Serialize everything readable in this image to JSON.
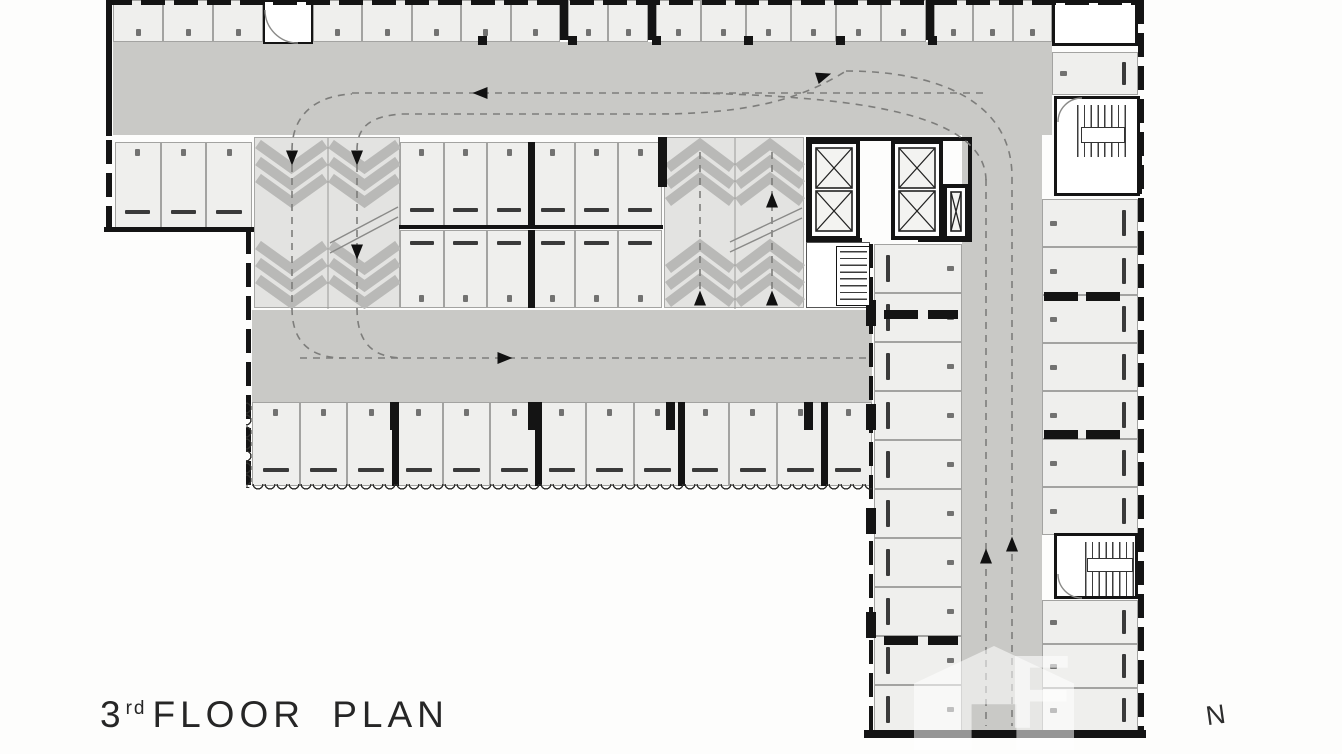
{
  "title": {
    "number": "3",
    "ordinal": "rd",
    "text": "FLOOR PLAN"
  },
  "north_label": "N",
  "watermark_label": "F",
  "colors": {
    "bg": "#fdfdfc",
    "lane": "#c9c9c6",
    "ramp": "#e3e3e1",
    "chevron": "#b9b9b7",
    "stall": "#efefed",
    "stall_border": "#a3a3a1",
    "wall": "#141414",
    "wheel_stop": "#3a3a3a",
    "path": "#7d7d7b",
    "solid_line": "#8a8a88",
    "arrow": "#111111",
    "text": "#262626"
  },
  "plan": {
    "lanes": [
      {
        "x": 113,
        "y": 42,
        "w": 939,
        "h": 93
      },
      {
        "x": 252,
        "y": 310,
        "w": 620,
        "h": 92
      },
      {
        "x": 962,
        "y": 135,
        "w": 80,
        "h": 597
      }
    ],
    "rooms": [
      {
        "x": 263,
        "y": 0,
        "w": 50,
        "h": 44,
        "b": "2px solid #141414"
      },
      {
        "x": 1052,
        "y": 0,
        "w": 86,
        "h": 46,
        "b": "3px solid #141414"
      },
      {
        "x": 806,
        "y": 242,
        "w": 64,
        "h": 66,
        "b": "1.5px solid #555555"
      }
    ],
    "stall_rows": [
      {
        "x": 113,
        "y": 0,
        "w": 150,
        "h": 42,
        "n": 3,
        "open": "down",
        "noStop": true
      },
      {
        "x": 313,
        "y": 0,
        "w": 247,
        "h": 42,
        "n": 5,
        "open": "down",
        "noStop": true
      },
      {
        "x": 568,
        "y": 0,
        "w": 80,
        "h": 42,
        "n": 2,
        "open": "down",
        "noStop": true
      },
      {
        "x": 656,
        "y": 0,
        "w": 270,
        "h": 42,
        "n": 6,
        "open": "down",
        "noStop": true
      },
      {
        "x": 934,
        "y": 0,
        "w": 118,
        "h": 42,
        "n": 3,
        "open": "down",
        "noStop": true
      },
      {
        "x": 115,
        "y": 142,
        "w": 137,
        "h": 86,
        "n": 3,
        "open": "up"
      },
      {
        "x": 400,
        "y": 142,
        "w": 262,
        "h": 84,
        "n": 6,
        "open": "up",
        "blockEvery": 3
      },
      {
        "x": 400,
        "y": 230,
        "w": 262,
        "h": 78,
        "n": 6,
        "open": "down",
        "blockEvery": 3
      },
      {
        "x": 252,
        "y": 402,
        "w": 620,
        "h": 84,
        "n": 13,
        "open": "up",
        "blockEvery": 3
      },
      {
        "x": 874,
        "y": 244,
        "w": 88,
        "h": 490,
        "n": 10,
        "open": "right"
      },
      {
        "x": 1042,
        "y": 199,
        "w": 96,
        "h": 336,
        "n": 7,
        "open": "left"
      },
      {
        "x": 1042,
        "y": 600,
        "w": 96,
        "h": 132,
        "n": 3,
        "open": "left"
      },
      {
        "x": 1052,
        "y": 52,
        "w": 86,
        "h": 43,
        "n": 1,
        "open": "left"
      }
    ],
    "ramps": [
      {
        "x": 254,
        "y": 137,
        "w": 146,
        "h": 171,
        "dir": "down"
      },
      {
        "x": 664,
        "y": 137,
        "w": 140,
        "h": 171,
        "dir": "up"
      }
    ],
    "walls": [
      {
        "x": 108,
        "y": 0,
        "w": 1034,
        "h": 5,
        "s": "dh"
      },
      {
        "x": 106,
        "y": 0,
        "w": 6,
        "h": 136,
        "s": "s"
      },
      {
        "x": 106,
        "y": 140,
        "w": 6,
        "h": 90,
        "s": "dv"
      },
      {
        "x": 104,
        "y": 227,
        "w": 150,
        "h": 5,
        "s": "s"
      },
      {
        "x": 246,
        "y": 230,
        "w": 5,
        "h": 258,
        "s": "dv"
      },
      {
        "x": 399,
        "y": 225,
        "w": 264,
        "h": 4,
        "s": "s"
      },
      {
        "x": 1138,
        "y": 0,
        "w": 6,
        "h": 736,
        "s": "dv"
      },
      {
        "x": 864,
        "y": 730,
        "w": 282,
        "h": 8,
        "s": "s"
      },
      {
        "x": 869,
        "y": 244,
        "w": 4,
        "h": 488,
        "s": "dv"
      },
      {
        "x": 658,
        "y": 137,
        "w": 9,
        "h": 50,
        "s": "s"
      },
      {
        "x": 560,
        "y": 0,
        "w": 8,
        "h": 40,
        "s": "s"
      },
      {
        "x": 648,
        "y": 0,
        "w": 8,
        "h": 40,
        "s": "s"
      },
      {
        "x": 926,
        "y": 0,
        "w": 8,
        "h": 40,
        "s": "s"
      },
      {
        "x": 806,
        "y": 137,
        "w": 166,
        "h": 4,
        "s": "s"
      },
      {
        "x": 806,
        "y": 238,
        "w": 56,
        "h": 4,
        "s": "s"
      },
      {
        "x": 918,
        "y": 238,
        "w": 54,
        "h": 4,
        "s": "s"
      },
      {
        "x": 968,
        "y": 137,
        "w": 4,
        "h": 104,
        "s": "s"
      },
      {
        "x": 806,
        "y": 137,
        "w": 4,
        "h": 104,
        "s": "s"
      }
    ],
    "wall_blocks": [
      {
        "x": 478,
        "y": 36,
        "w": 9,
        "h": 9
      },
      {
        "x": 568,
        "y": 36,
        "w": 9,
        "h": 9
      },
      {
        "x": 652,
        "y": 36,
        "w": 9,
        "h": 9
      },
      {
        "x": 744,
        "y": 36,
        "w": 9,
        "h": 9
      },
      {
        "x": 836,
        "y": 36,
        "w": 9,
        "h": 9
      },
      {
        "x": 928,
        "y": 36,
        "w": 9,
        "h": 9
      },
      {
        "x": 884,
        "y": 310,
        "w": 34,
        "h": 9
      },
      {
        "x": 928,
        "y": 310,
        "w": 30,
        "h": 9
      },
      {
        "x": 884,
        "y": 636,
        "w": 34,
        "h": 9
      },
      {
        "x": 928,
        "y": 636,
        "w": 30,
        "h": 9
      },
      {
        "x": 1044,
        "y": 292,
        "w": 34,
        "h": 9
      },
      {
        "x": 1086,
        "y": 292,
        "w": 34,
        "h": 9
      },
      {
        "x": 1044,
        "y": 430,
        "w": 34,
        "h": 9
      },
      {
        "x": 1086,
        "y": 430,
        "w": 34,
        "h": 9
      },
      {
        "x": 866,
        "y": 300,
        "w": 10,
        "h": 26
      },
      {
        "x": 866,
        "y": 404,
        "w": 10,
        "h": 26
      },
      {
        "x": 866,
        "y": 508,
        "w": 10,
        "h": 26
      },
      {
        "x": 866,
        "y": 612,
        "w": 10,
        "h": 26
      },
      {
        "x": 390,
        "y": 402,
        "w": 9,
        "h": 28
      },
      {
        "x": 528,
        "y": 402,
        "w": 9,
        "h": 28
      },
      {
        "x": 666,
        "y": 402,
        "w": 9,
        "h": 28
      },
      {
        "x": 804,
        "y": 402,
        "w": 9,
        "h": 28
      }
    ],
    "shafts": [
      {
        "x": 808,
        "y": 140,
        "w": 52,
        "h": 100,
        "cells": 2
      },
      {
        "x": 891,
        "y": 140,
        "w": 52,
        "h": 100,
        "cells": 2
      },
      {
        "x": 943,
        "y": 184,
        "w": 26,
        "h": 56,
        "cells": 1
      },
      {
        "x": 1096,
        "y": 148,
        "w": 46,
        "h": 46,
        "cells": 1
      }
    ],
    "stairs": [
      {
        "x": 1054,
        "y": 96,
        "w": 86,
        "h": 100,
        "dir": "v",
        "t": [
          20,
          6,
          50,
          52
        ],
        "landing": [
          24,
          28,
          44,
          16
        ]
      },
      {
        "x": 1054,
        "y": 533,
        "w": 84,
        "h": 66,
        "dir": "v",
        "t": [
          28,
          6,
          52,
          54
        ],
        "landing": [
          30,
          22,
          46,
          14
        ]
      },
      {
        "x": 836,
        "y": 246,
        "w": 34,
        "h": 60,
        "dir": "h",
        "t": [
          3,
          4,
          27,
          52
        ],
        "thin": true
      }
    ],
    "scallops": [
      {
        "x": 252,
        "y": 484,
        "w": 620,
        "h": 7,
        "dir": "h"
      },
      {
        "x": 246,
        "y": 402,
        "w": 7,
        "h": 86,
        "dir": "v"
      }
    ],
    "paths_dashed": [
      "M292 152 V306",
      "M357 152 V306",
      "M292 150 C292 118 312 96 352 94",
      "M357 150 C357 124 374 116 402 114",
      "M352 93 H986",
      "M402 114 H656 C756 114 806 96 846 71",
      "M846 71 C934 71 1012 99 1012 177",
      "M700 93 C830 97 986 107 986 181",
      "M986 179 V726",
      "M1012 177 V726",
      "M300 358 H868",
      "M292 308 C292 342 310 358 344 358",
      "M357 308 C357 342 372 358 404 358",
      "M700 152 V306",
      "M772 152 V306"
    ],
    "paths_solid": [
      "M330 243 L398 207",
      "M330 253 L398 217",
      "M730 242 L802 208",
      "M730 252 L802 218",
      "M265 10 A33 33 0 0 0 298 43",
      "M1058 122 A24 24 0 0 1 1082 98",
      "M1058 574 A24 24 0 0 0 1082 598"
    ],
    "arrows": [
      {
        "x": 480,
        "y": 93,
        "dir": "left"
      },
      {
        "x": 824,
        "y": 76,
        "dir": "right",
        "rot": -18
      },
      {
        "x": 292,
        "y": 158,
        "dir": "down"
      },
      {
        "x": 357,
        "y": 158,
        "dir": "down"
      },
      {
        "x": 357,
        "y": 252,
        "dir": "down"
      },
      {
        "x": 772,
        "y": 200,
        "dir": "up"
      },
      {
        "x": 700,
        "y": 298,
        "dir": "up"
      },
      {
        "x": 772,
        "y": 298,
        "dir": "up"
      },
      {
        "x": 505,
        "y": 358,
        "dir": "right"
      },
      {
        "x": 986,
        "y": 556,
        "dir": "up"
      },
      {
        "x": 1012,
        "y": 544,
        "dir": "up"
      }
    ]
  }
}
